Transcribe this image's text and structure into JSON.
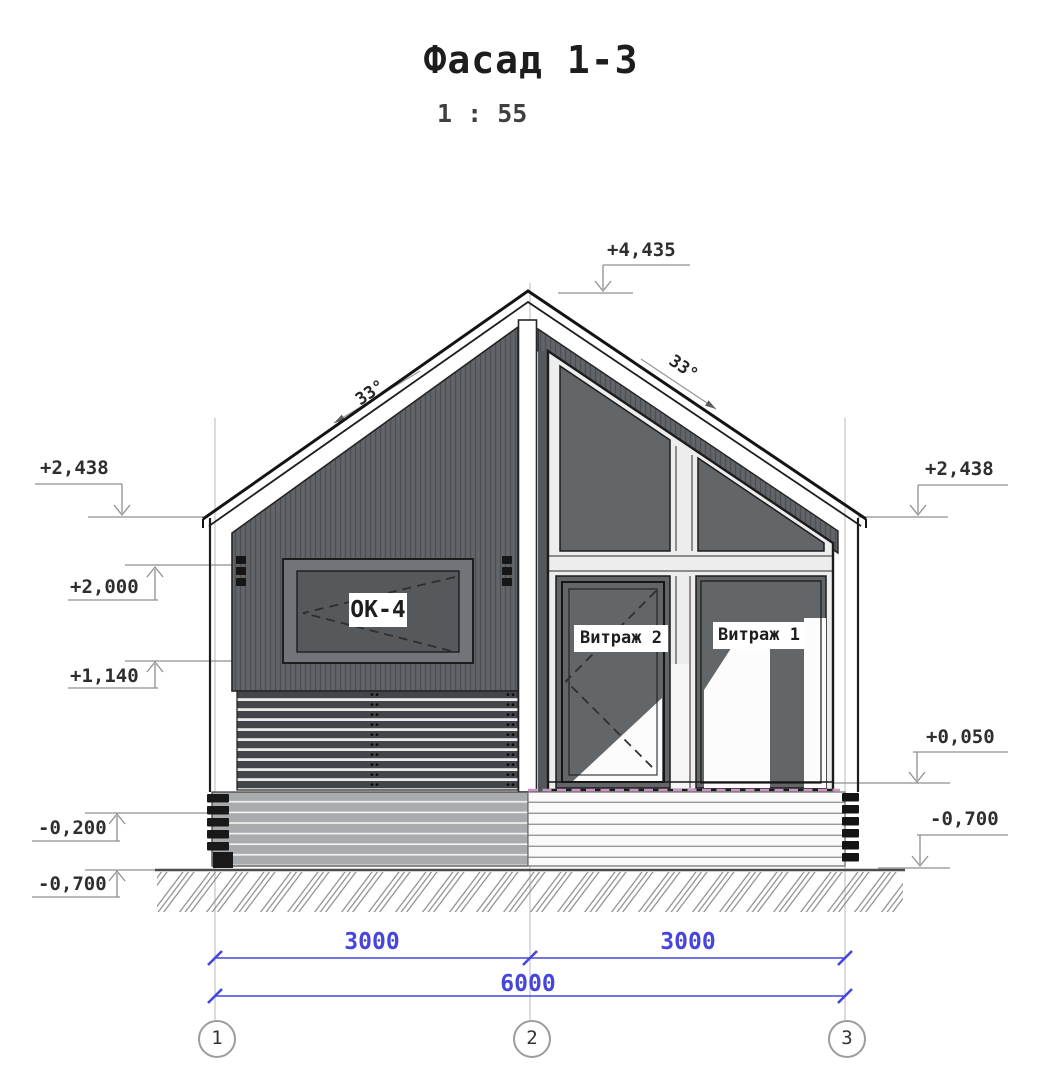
{
  "title": "Фасад 1-3",
  "scale": "1 : 55",
  "elevations": {
    "ridge": "+4,435",
    "eave_left": "+2,438",
    "eave_right": "+2,438",
    "window_head": "+2,000",
    "window_sill": "+1,140",
    "plinth": "-0,200",
    "ground_left": "-0,700",
    "terrace": "+0,050",
    "ground_right": "-0,700"
  },
  "angles": {
    "left_slope": "33°",
    "right_slope": "33°"
  },
  "labels": {
    "window": "ОК-4",
    "vitrage_2": "Витраж 2",
    "vitrage_1": "Витраж 1"
  },
  "dimensions": {
    "bay_1_2": "3000",
    "bay_2_3": "3000",
    "overall": "6000"
  },
  "axes": [
    "1",
    "2",
    "3"
  ],
  "colors": {
    "dimension_blue": "#4646dd",
    "siding_gray": "#5d6164",
    "glass_gray": "#626669",
    "deck_dashed_pink": "#cf93c6"
  }
}
